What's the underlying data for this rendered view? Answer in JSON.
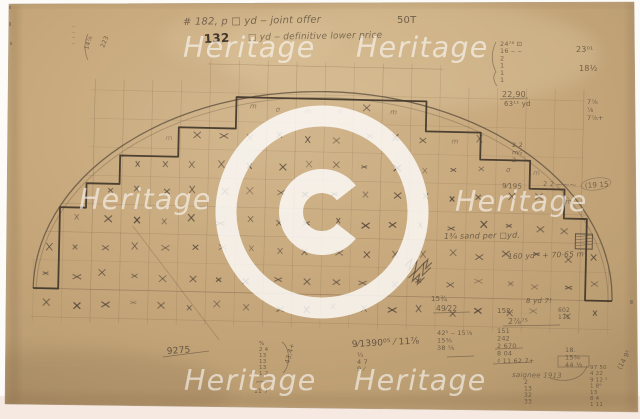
{
  "paper": {
    "polygon": "9,4 634,2 638,412 5,404",
    "base_color": "#c7a87c",
    "light_color": "#d3b78e",
    "dark_color": "#b1946a",
    "margin_color": "#fdfbf8",
    "bottom_strip_color": "#f6e9e1",
    "pencil_color": "#5a4b3b",
    "dark_pencil_color": "#41362a"
  },
  "watermark": {
    "text": "Heritage",
    "color": "#ffffff",
    "text_opacity": 0.58,
    "font_size": 28.5,
    "positions": [
      {
        "x": 183,
        "y": 57
      },
      {
        "x": 356,
        "y": 57
      },
      {
        "x": 79,
        "y": 209
      },
      {
        "x": 455,
        "y": 211
      },
      {
        "x": 184,
        "y": 390
      },
      {
        "x": 354,
        "y": 390
      }
    ],
    "copyright": {
      "symbol": "©",
      "cx": 322,
      "cy": 212,
      "ring_r": 96,
      "ring_w": 21,
      "c_r": 31,
      "c_w": 24,
      "gap_deg": 38,
      "opacity": 0.8
    }
  },
  "drawing": {
    "rotation": 1.3,
    "grid": {
      "x0": 35,
      "cols": 21,
      "dx": 28.75,
      "y0": 66.5,
      "rows": 10,
      "dy": 28.5,
      "color": "#93795a"
    },
    "arch": {
      "cx": 324.5,
      "base": 294.5,
      "rx": 289.5,
      "ry": 203,
      "rx2": 286,
      "ry2": 199,
      "base2": 296.5
    },
    "steps": [
      [
        35,
        294.5
      ],
      [
        60,
        294.5
      ],
      [
        60,
        213
      ],
      [
        86,
        213
      ],
      [
        86,
        188.5
      ],
      [
        119,
        188.5
      ],
      [
        119,
        160
      ],
      [
        177,
        160
      ],
      [
        177,
        130.5
      ],
      [
        234,
        130.5
      ],
      [
        234,
        99
      ],
      [
        424,
        99
      ],
      [
        424,
        129
      ],
      [
        479,
        129
      ],
      [
        479,
        156
      ],
      [
        529,
        156
      ],
      [
        529,
        184
      ],
      [
        564,
        184
      ],
      [
        564,
        213
      ],
      [
        587,
        213
      ],
      [
        587,
        294.5
      ],
      [
        614,
        294.5
      ]
    ],
    "hatch_box": {
      "x": 576,
      "y": 228,
      "w": 17,
      "h": 15
    },
    "diagonal": [
      133,
      230,
      222,
      342
    ],
    "scribbles": [
      "M406,264 l7,-7 l-3,11 l8,-9 l-2,12 l9,-10 l-1,12 l8,-8",
      "M410,276 l6,-6 l-2,9 l7,-7 l-2,10 l7,-7",
      "M424,262 l5,-5 l-2,9 l6,-6"
    ],
    "brackets": [
      "M496,42 C491,52 491,62 496,72 C492,76 494,82 497,86",
      "M88,34 C84,42 84,52 88,60",
      "M282,342 C290,348 291,365 283,373",
      "M587,366 C583,378 568,384 550,378"
    ],
    "rules": [
      [
        500,
        99,
        528,
        98
      ],
      [
        433,
        313,
        470,
        312
      ],
      [
        503,
        326,
        560,
        325
      ],
      [
        495,
        349,
        523,
        348
      ],
      [
        493,
        364,
        532,
        362
      ],
      [
        447,
        357,
        474,
        356
      ],
      [
        163,
        357,
        209,
        351
      ],
      [
        256,
        382,
        272,
        381
      ]
    ],
    "boxes": [
      [
        558,
        356,
        31,
        11
      ]
    ],
    "circled": [
      [
        596,
        184,
        15,
        6,
        -8
      ]
    ],
    "annotations": [
      {
        "x": 72,
        "y": 28,
        "lines": [
          "‒",
          "‒",
          "‒",
          "‒"
        ],
        "s": 5,
        "lh": 5.5,
        "o": 0.55
      },
      {
        "x": 88,
        "y": 50,
        "t": "14⅞",
        "s": 6,
        "r": -72
      },
      {
        "x": 104,
        "y": 48,
        "t": "223",
        "s": 6,
        "r": -68
      },
      {
        "x": 183,
        "y": 25,
        "t": "# 182, p  □ yd ‒  joint offer",
        "s": 10,
        "i": 1,
        "r": -1,
        "o": 0.75
      },
      {
        "x": 204,
        "y": 43,
        "t": "132",
        "s": 12,
        "b": 1,
        "c": "#3a3128",
        "r": -3,
        "o": 0.95
      },
      {
        "x": 248,
        "y": 40,
        "t": "□ yd ‒  definitive lower price",
        "s": 9,
        "i": 1,
        "o": 0.7,
        "r": -1
      },
      {
        "x": 397,
        "y": 23,
        "t": "50T",
        "s": 10,
        "o": 0.8
      },
      {
        "x": 500,
        "y": 46,
        "lines": [
          "24⁷⁸ ⊡",
          "16 ‒ ‒",
          "2",
          "1",
          "1",
          "1"
        ],
        "s": 6.5,
        "lh": 7.2,
        "o": 0.75
      },
      {
        "x": 502,
        "y": 97,
        "t": "22,90",
        "s": 8
      },
      {
        "x": 504,
        "y": 106,
        "t": "63¹¹ yd",
        "s": 7
      },
      {
        "x": 576,
        "y": 52,
        "t": "23⁰¹",
        "s": 8
      },
      {
        "x": 579,
        "y": 71,
        "t": "18½",
        "s": 8
      },
      {
        "x": 587,
        "y": 104,
        "lines": [
          "7⅞",
          "⅞",
          "7⅞+"
        ],
        "s": 6.5,
        "lh": 8
      },
      {
        "x": 512,
        "y": 147,
        "lines": [
          "2 2",
          "m⁄₂",
          "2"
        ],
        "s": 6.5,
        "lh": 7.5
      },
      {
        "x": 502,
        "y": 188,
        "t": "9⁄195",
        "s": 7,
        "r": 2
      },
      {
        "x": 543,
        "y": 186,
        "t": "2 2 ⁓⁓⁓",
        "s": 6.5,
        "r": 2,
        "o": 0.7
      },
      {
        "x": 585,
        "y": 188,
        "t": "(19 15",
        "s": 7,
        "r": -4
      },
      {
        "x": 444,
        "y": 239,
        "t": "1¾ sand per □yd.",
        "s": 8,
        "i": 1,
        "r": -1,
        "o": 0.8
      },
      {
        "x": 508,
        "y": 259,
        "t": "160 ydᵐ + 70·65 m³",
        "s": 7.5,
        "i": 1,
        "r": -2,
        "o": 0.8
      },
      {
        "x": 431,
        "y": 301,
        "t": "15¾",
        "s": 7
      },
      {
        "x": 436,
        "y": 311,
        "t": "49⁄22",
        "s": 7.5
      },
      {
        "x": 526,
        "y": 303,
        "t": "8 yd 7!",
        "s": 7,
        "i": 1
      },
      {
        "x": 497,
        "y": 313,
        "t": "152.",
        "s": 7
      },
      {
        "x": 558,
        "y": 312,
        "lines": [
          "602",
          "171"
        ],
        "s": 6,
        "lh": 7
      },
      {
        "x": 508,
        "y": 324,
        "t": "2⅞⁷⁵",
        "s": 8
      },
      {
        "x": 497,
        "y": 333,
        "lines": [
          "151",
          "242",
          "2 670",
          "8 04",
          "♯ 11 62 7+"
        ],
        "s": 6.5,
        "lh": 7.5
      },
      {
        "x": 437,
        "y": 335,
        "lines": [
          "42⁵ ‒ 15⅞",
          "15⅜",
          "38 ⅝"
        ],
        "s": 6.5,
        "lh": 7.5
      },
      {
        "x": 565,
        "y": 352,
        "lines": [
          "18.",
          "15¾",
          "44 ⅛"
        ],
        "s": 6.5,
        "lh": 7.5
      },
      {
        "x": 590,
        "y": 369,
        "lines": [
          "97 50",
          "4 22",
          "9 12 ⁵",
          "1 8⁶",
          "13",
          "8 4",
          "1 11"
        ],
        "s": 5.5,
        "lh": 6.2
      },
      {
        "x": 621,
        "y": 370,
        "t": "(14 9⁵",
        "s": 6.5,
        "r": -62
      },
      {
        "x": 512,
        "y": 377,
        "t": "saignee   1913",
        "s": 7,
        "i": 1,
        "r": 1,
        "o": 0.7
      },
      {
        "x": 524,
        "y": 384,
        "lines": [
          "2",
          "13",
          "32",
          "33"
        ],
        "s": 6,
        "lh": 6.5
      },
      {
        "x": 352,
        "y": 347,
        "t": "9⁄1390⁰⁵ ⁄ 11⅞",
        "s": 9,
        "r": -3,
        "c": "#4a3e31"
      },
      {
        "x": 357,
        "y": 357,
        "lines": [
          "¼",
          "4 7",
          "9 ⁄"
        ],
        "s": 6.5,
        "lh": 7
      },
      {
        "x": 167,
        "y": 354,
        "t": "9275",
        "s": 9,
        "r": -4,
        "c": "#4a3e31"
      },
      {
        "x": 259,
        "y": 345,
        "lines": [
          "%",
          "2 4",
          "13",
          "13",
          "13",
          "1 2"
        ],
        "s": 5.5,
        "lh": 6
      },
      {
        "x": 254,
        "y": 393,
        "t": "11 7",
        "s": 6
      },
      {
        "x": 289,
        "y": 364,
        "t": "43,4+",
        "s": 6.5,
        "r": -75
      }
    ]
  }
}
